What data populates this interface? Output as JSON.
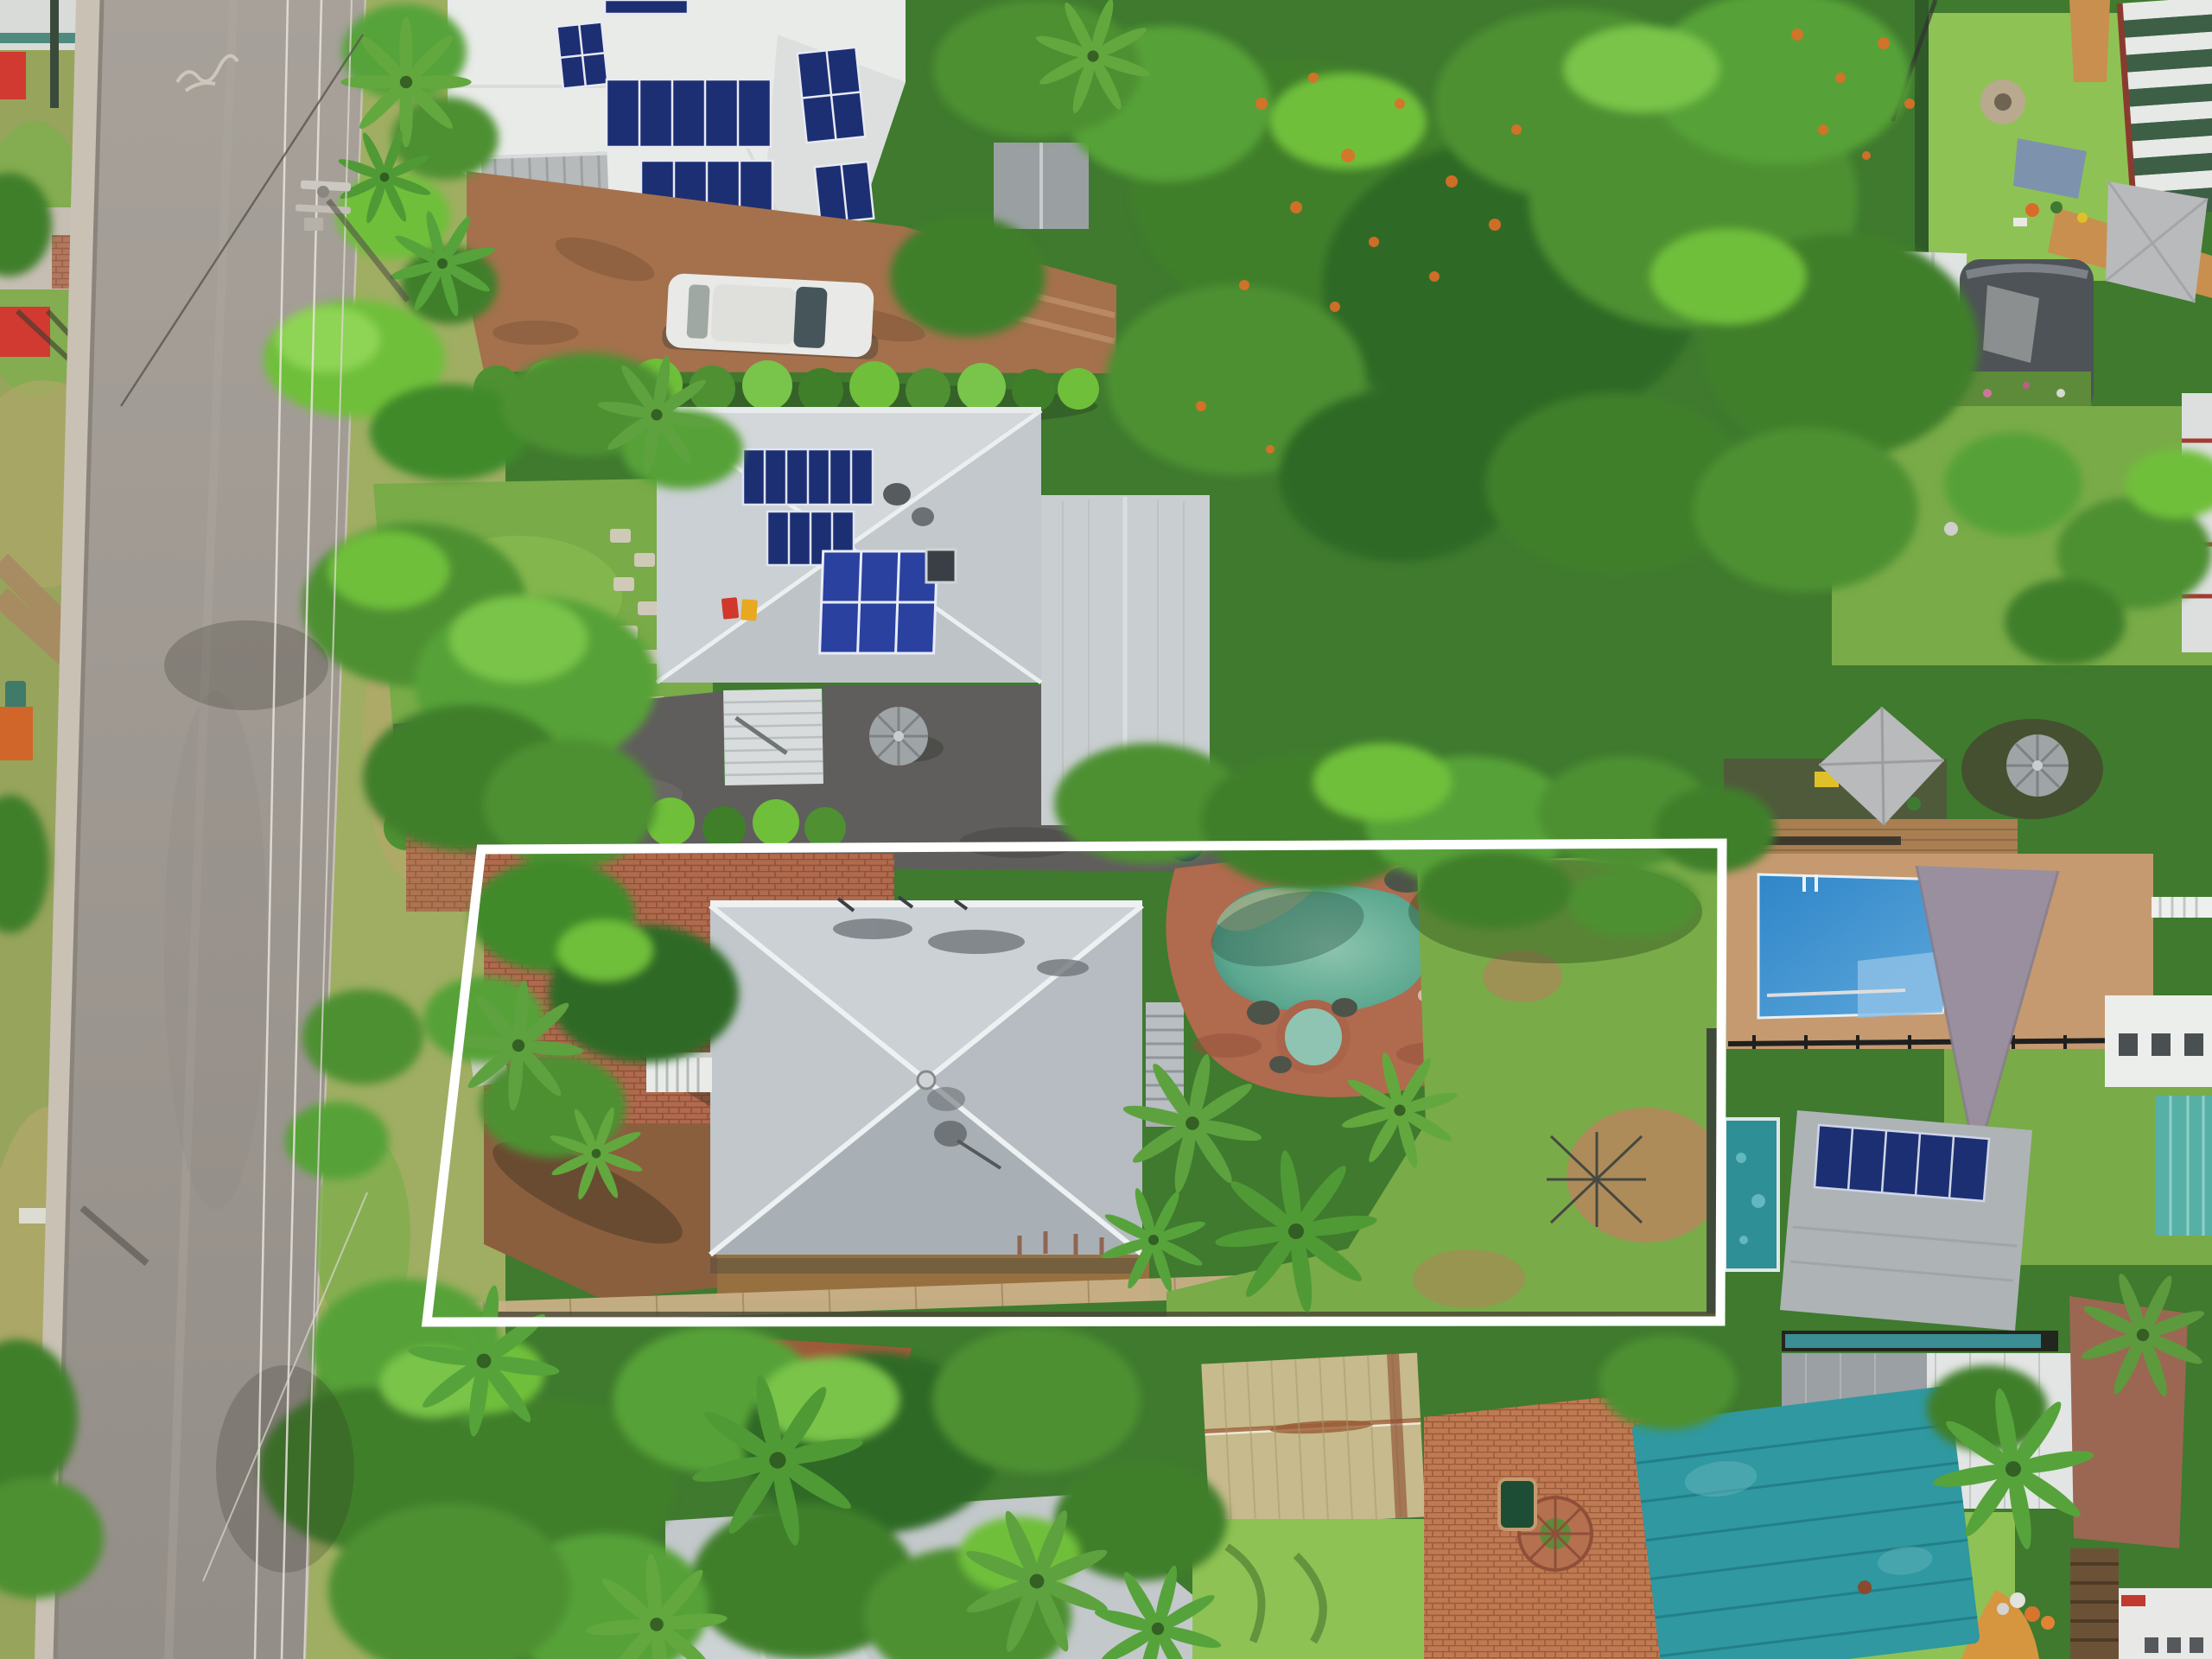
{
  "meta": {
    "type": "aerial-drone-photograph",
    "subject": "residential property for sale highlighted with white lot-boundary outline",
    "view": "top-down"
  },
  "palette": {
    "boundary": "#ffffff",
    "road": "#a19a93",
    "sidewalk": "#c9c1b4",
    "grass_verge": "#9fae62",
    "lawn": "#79ab48",
    "lawn_bright": "#8fc254",
    "tree_dark": "#2f6b26",
    "tree_mid": "#4e9032",
    "tree_bright": "#6fbf3a",
    "palm": "#57a33b",
    "poinciana_orange": "#df6f28",
    "roof_white": "#e9ebe9",
    "roof_light": "#d3d7da",
    "roof_mid": "#c3c8cc",
    "subject_roof_n": "#ccd1d5",
    "subject_roof_e": "#b6bcc1",
    "subject_roof_s": "#a9b0b5",
    "subject_roof_w": "#c1c7cb",
    "ridge_white": "#eef1f2",
    "solar_panel": "#1d2f73",
    "solar_panel_bright": "#2a41a0",
    "asphalt": "#5f5e5c",
    "drive_brown": "#a4714c",
    "brick": "#b06a4e",
    "paving_tan": "#c59a70",
    "pool_teal": "#5ba78f",
    "pool_teal_deep": "#3e7f6e",
    "spa_teal": "#8fc4b2",
    "blue_pool": "#2f86c8",
    "blue_pool_light": "#8cc0e6",
    "pool_cover": "#2f98a0",
    "lap_pool": "#2e8f96",
    "tan_shed": "#c7ba8d",
    "rust": "#9a5c35",
    "sail_gray": "#b9babc",
    "sail_mauve": "#9a8f9e",
    "tank_gray": "#9fa4a6",
    "deck": "#a97f52",
    "timber_pale": "#c9b088",
    "fence_dark": "#2e2e28",
    "gravel": "#9b6752",
    "striped_green": "#3c5f46",
    "striped_white": "#e7e9e6",
    "car": "#e9e9e7",
    "bin_red": "#d2372c",
    "bin_yellow": "#e8a81f",
    "playground_red": "#d03a30",
    "bench_teal": "#3f7a6a",
    "tarp_blue": "#7d93ad",
    "hose_blue": "#35a7d8",
    "clutter_yellow": "#e0c02a",
    "dirt": "#b08a5c",
    "mulch": "#8a5f3e"
  },
  "scene": {
    "boundary": {
      "shape": "quadrilateral",
      "corners": [
        [
          557,
          983
        ],
        [
          1993,
          976
        ],
        [
          1991,
          1529
        ],
        [
          494,
          1530
        ]
      ],
      "stroke_width": 11,
      "label": "property-boundary-outline"
    },
    "features": [
      {
        "name": "street",
        "label": "suburban road running vertically on left with power lines"
      },
      {
        "name": "power-pole",
        "label": "power pole with crossarm casting shadow"
      },
      {
        "name": "park-strip",
        "label": "grass verge with playground equipment, bench and footpaths"
      },
      {
        "name": "house-top",
        "label": "neighbour house with white roof and blue solar panels"
      },
      {
        "name": "white-car",
        "label": "white car parked on brown paved driveway"
      },
      {
        "name": "house-second",
        "label": "neighbour house with light grey hip roof, 16 solar panels, skylight, satellite dishes"
      },
      {
        "name": "round-water-tank",
        "label": "round grey rainwater tank"
      },
      {
        "name": "white-garden-shed",
        "label": "white corrugated garden shed on dark gravel driveway"
      },
      {
        "name": "wheelie-bins",
        "label": "red and yellow wheelie bins"
      },
      {
        "name": "subject-house",
        "label": "pyramid hip-roof house inside highlighted lot"
      },
      {
        "name": "subject-pool",
        "label": "freeform teal swimming pool with spa and rock surround"
      },
      {
        "name": "subject-yard",
        "label": "brick courtyard, palms, rear lawn with bare dirt patches, clothesline"
      },
      {
        "name": "poinciana",
        "label": "large tree canopy with orange flowers at top right"
      },
      {
        "name": "neighbour-blue-pool",
        "label": "rectangular blue pool with tan paving, shade sail and square umbrella"
      },
      {
        "name": "neighbour-solar-shed",
        "label": "shed roof with solar panel row beside teal lap pool"
      },
      {
        "name": "gable-shed",
        "label": "large grey/white gable shed with lawn and pumpkins"
      },
      {
        "name": "striped-roof-house",
        "label": "green and white striped roof house top right"
      },
      {
        "name": "bottom-sheds",
        "label": "tan rusted shed, brick patio with circular mosaic, teal pool cover"
      },
      {
        "name": "bottom-house",
        "label": "light grey hip roof house at bottom among palms"
      }
    ]
  }
}
